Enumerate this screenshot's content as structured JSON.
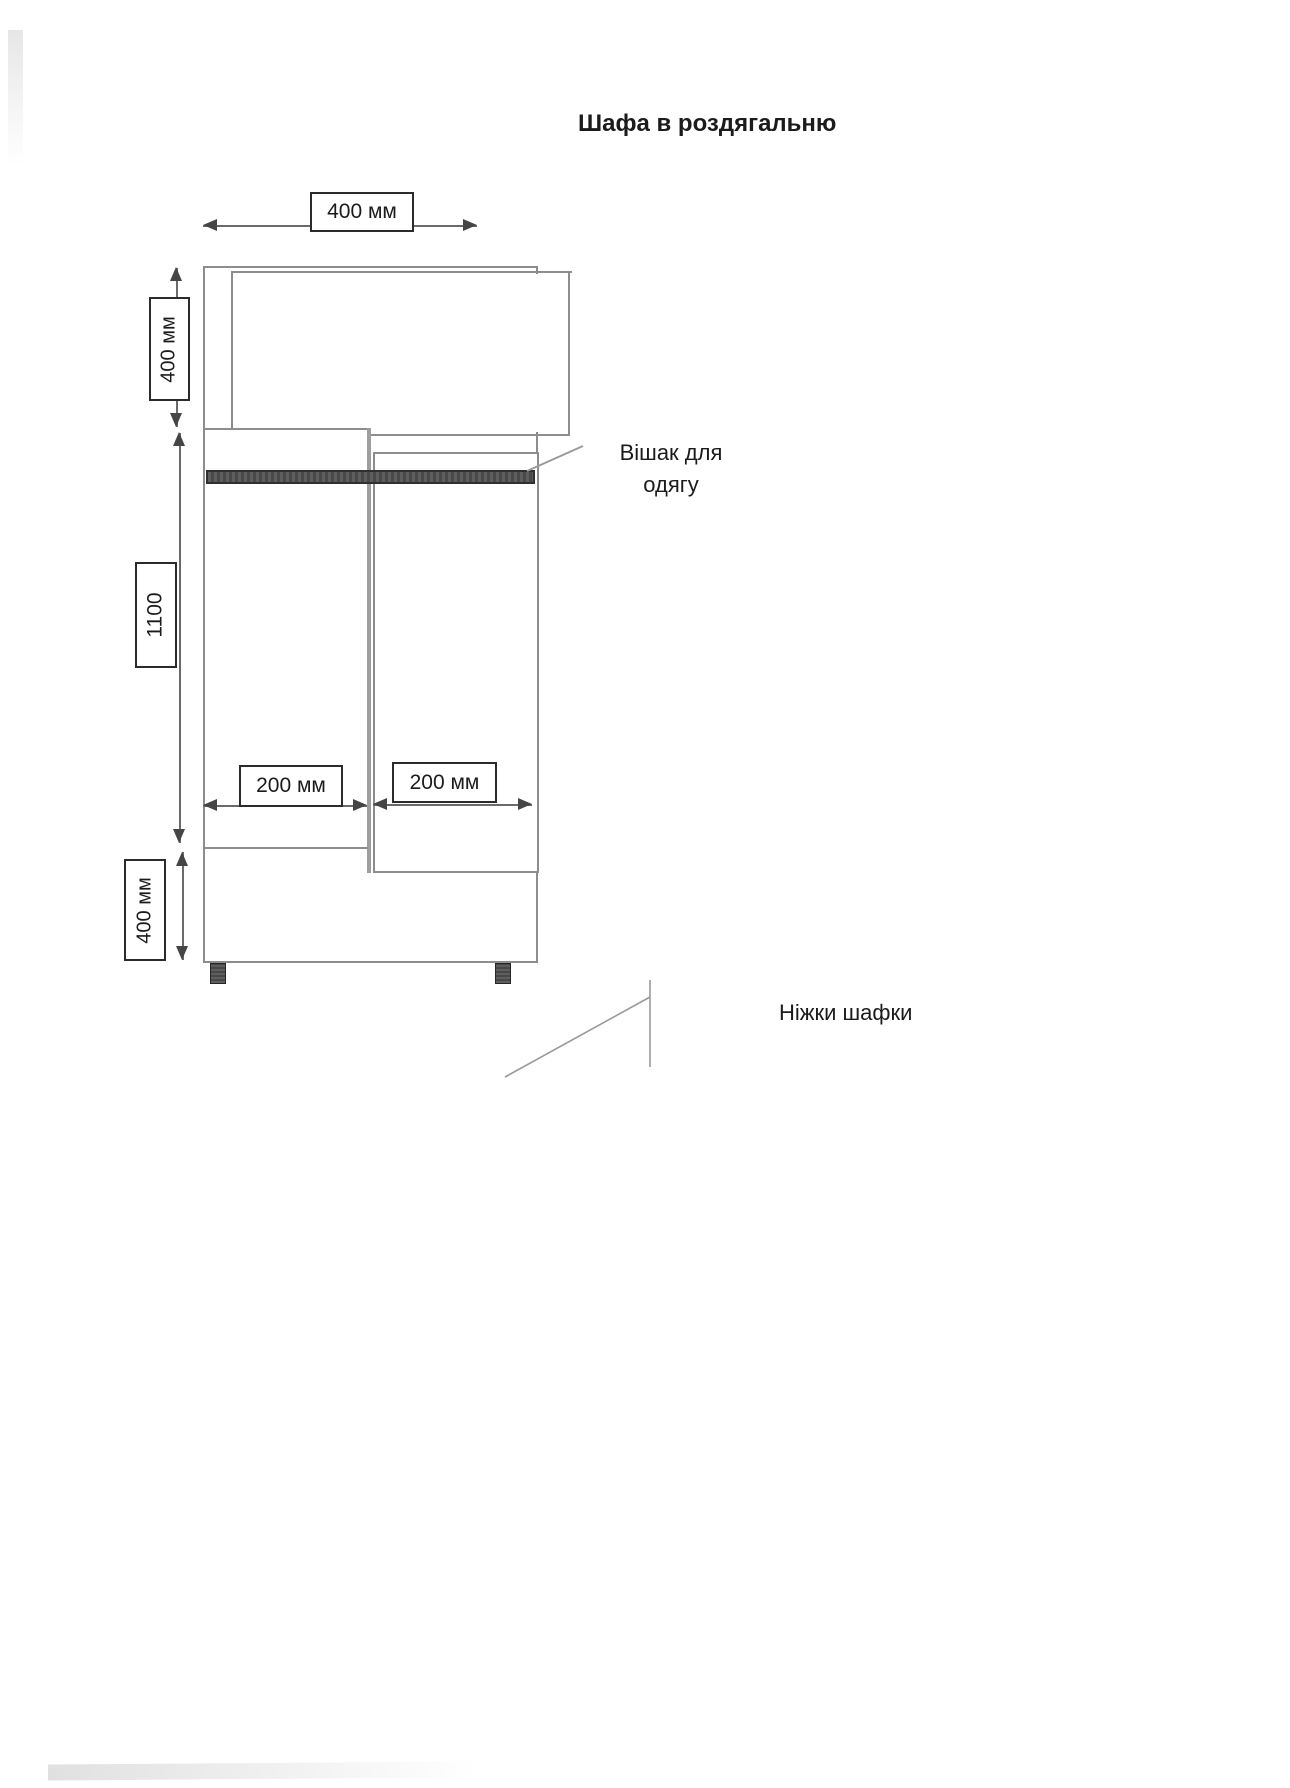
{
  "title": "Шафа в роздягальню",
  "dims": {
    "top_width": "400 мм",
    "upper_height": "400 мм",
    "middle_height": "1100",
    "lower_height": "400 мм",
    "left_compartment_width": "200 мм",
    "right_compartment_width": "200 мм"
  },
  "callouts": {
    "hanger_line1": "Вішак для",
    "hanger_line2": "одягу",
    "legs": "Ніжки шафки"
  },
  "colors": {
    "paper": "#ffffff",
    "cabinet_line": "#8d8d8d",
    "dim_line": "#6a6a6a",
    "arrow": "#454545",
    "box_border": "#2b2b2b",
    "text": "#1b1b1b",
    "dark_fill": "#525252",
    "leader": "#9a9a9a"
  }
}
